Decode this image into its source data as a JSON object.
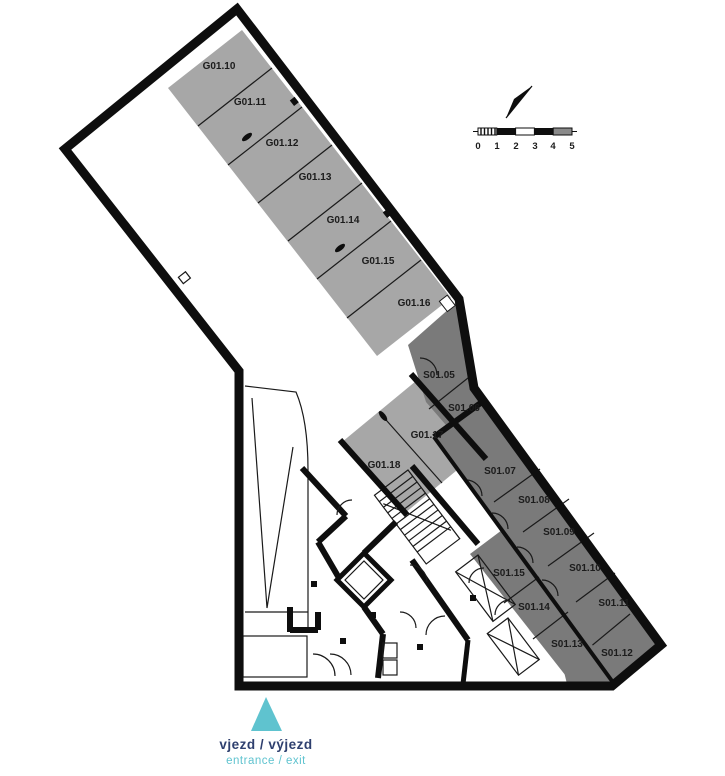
{
  "plan_type": "floor-plan",
  "colors": {
    "parking_fill": "#a7a7a7",
    "storage_fill": "#7a7a7a",
    "wall": "#0e0e0e",
    "accent_teal": "#5fc3cf",
    "accent_navy": "#2e3f6e"
  },
  "rooms": {
    "garage": [
      "G01.10",
      "G01.11",
      "G01.12",
      "G01.13",
      "G01.14",
      "G01.15",
      "G01.16",
      "G01.17",
      "G01.18"
    ],
    "storage": [
      "S01.05",
      "S01.06",
      "S01.07",
      "S01.08",
      "S01.09",
      "S01.10",
      "S01.11",
      "S01.12",
      "S01.13",
      "S01.14",
      "S01.15"
    ]
  },
  "scale_bar": {
    "ticks": [
      "0",
      "1",
      "2",
      "3",
      "4",
      "5"
    ]
  },
  "entrance": {
    "label_cs": "vjezd / výjezd",
    "label_en": "entrance / exit"
  }
}
